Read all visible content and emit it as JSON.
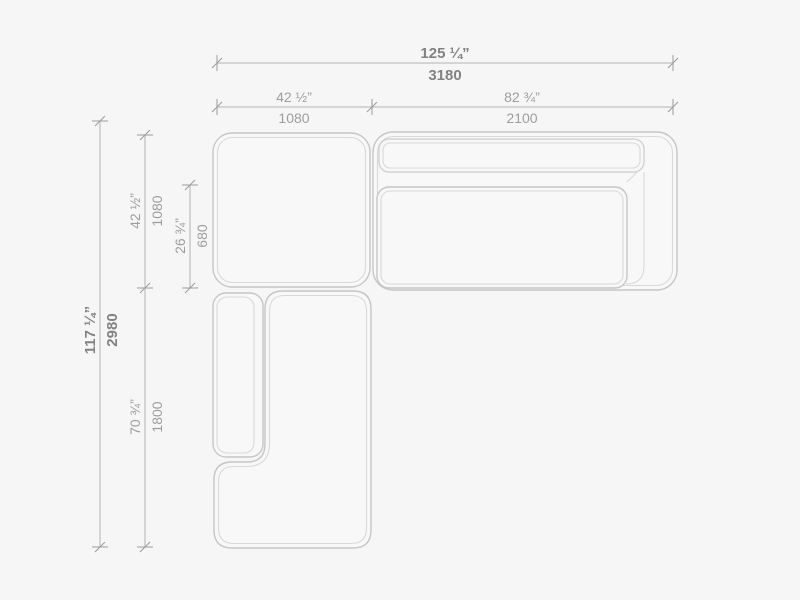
{
  "colors": {
    "background": "#f6f6f6",
    "outline": "#c6c6c6",
    "outline_light": "#d9d9d9",
    "dimension_line": "#b3b3b3",
    "text_primary": "#828282",
    "text_secondary": "#9d9d9d"
  },
  "dimensions": {
    "overall_width": {
      "inches": "125 ¼”",
      "mm": "3180"
    },
    "module_width_left": {
      "inches": "42 ½”",
      "mm": "1080"
    },
    "module_width_right": {
      "inches": "82 ¾”",
      "mm": "2100"
    },
    "overall_depth": {
      "inches": "117 ¼”",
      "mm": "2980"
    },
    "module_depth_top": {
      "inches": "42 ½”",
      "mm": "1080"
    },
    "seat_depth": {
      "inches": "26 ¾”",
      "mm": "680"
    },
    "chaise_length": {
      "inches": "70 ¾”",
      "mm": "1800"
    }
  }
}
